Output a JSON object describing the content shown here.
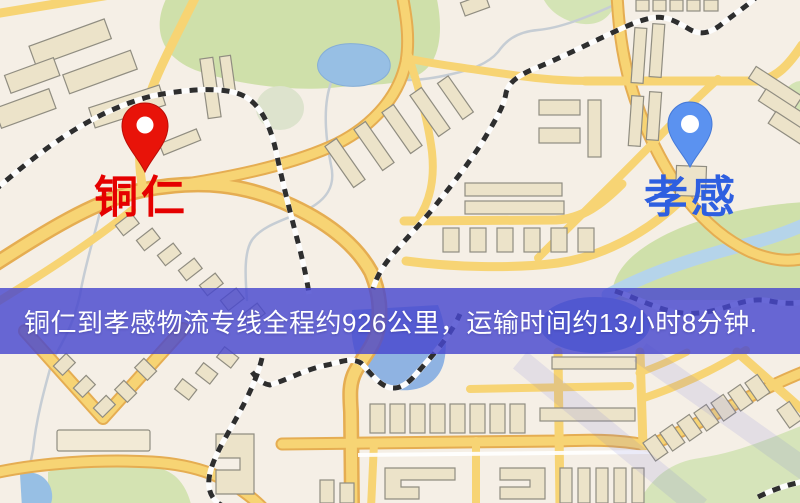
{
  "map": {
    "origin_marker": {
      "name": "铜仁",
      "pin": "red-map-pin",
      "pin_color": "#e81309",
      "label_color": "#e50000"
    },
    "destination_marker": {
      "name": "孝感",
      "pin": "blue-map-pin",
      "pin_color": "#5b92f0",
      "label_color": "#2e5fe0"
    },
    "style_colors": {
      "background": "#f5efe6",
      "park_green": "#cfe0aa",
      "water_blue": "#97bfe4",
      "road_yellow": "#f7d474",
      "road_casing": "#e5ad52",
      "railway_dash": "#2e2e2e"
    }
  },
  "banner": {
    "text": "铜仁到孝感物流专线全程约926公里，运输时间约13小时8分钟.",
    "origin": "铜仁",
    "destination": "孝感",
    "distance": "约926公里",
    "duration": "约13小时8分钟",
    "background_color": "#4848ce",
    "text_color": "#ffffff"
  }
}
